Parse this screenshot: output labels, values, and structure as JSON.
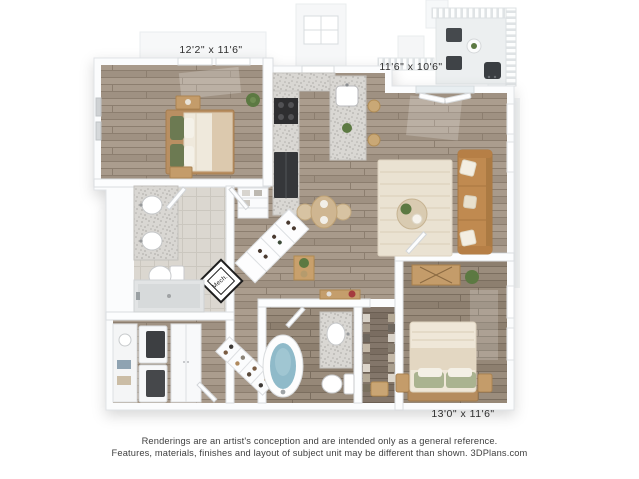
{
  "floorplan": {
    "dimension_labels": {
      "bedroom_top_left": "12'2\" x 11'6\"",
      "living_room": "11'6\" x 10'6\"",
      "bedroom_bottom_right": "13'0\" x 11'6\""
    },
    "room_tags": {
      "mech": "Mech."
    },
    "colors": {
      "background": "#ffffff",
      "wall": "#fcfdfe",
      "wall_edge": "#dadde0",
      "wood_floor": "#a89a8b",
      "wood_floor_dark": "#968878",
      "wood_floor_darker": "#83766a",
      "bath_tile": "#dbd7d0",
      "granite_counter": "#d9d7d3",
      "sofa_leather": "#c08a50",
      "rug_cream": "#eae2d2",
      "tub_water": "#8fbac9",
      "plant_green": "#5c7942",
      "pillow_sage": "#aab390",
      "wood_furniture": "#c49c6a",
      "label_text": "#2e2e2e",
      "disclaimer_text": "#3f3f3f"
    }
  },
  "footer": {
    "disclaimer_line1": "Renderings are an artist's conception and are intended only as a general reference.",
    "disclaimer_line2": "Features, materials, finishes and layout of subject unit may be different than shown. 3DPlans.com"
  }
}
